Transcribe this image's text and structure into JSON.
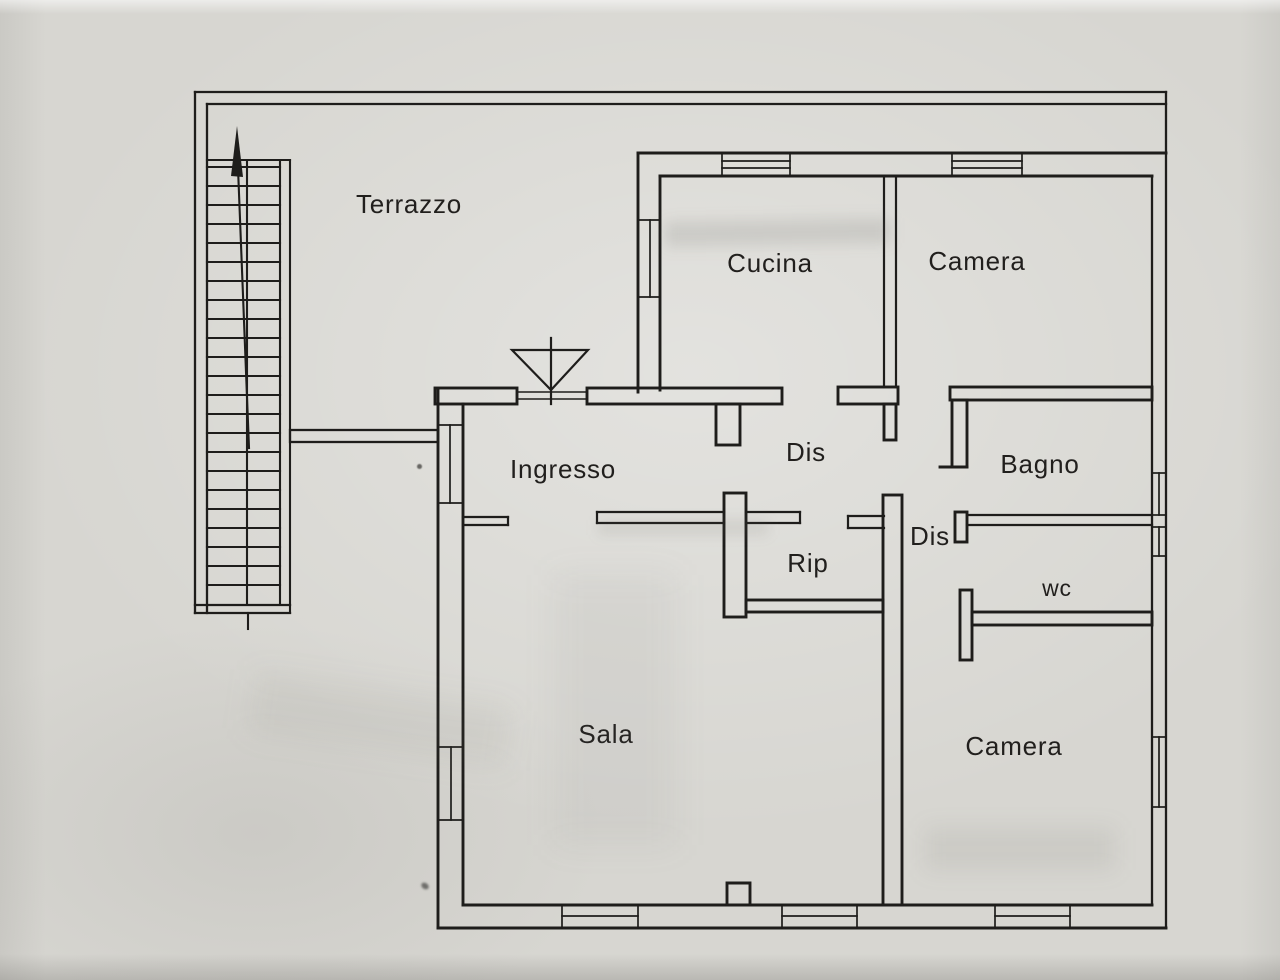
{
  "colors": {
    "paper": "#d7d6d1",
    "ink": "#1e1d1b"
  },
  "rooms": [
    {
      "id": "terrazzo",
      "label": "Terrazzo"
    },
    {
      "id": "cucina",
      "label": "Cucina"
    },
    {
      "id": "camera-nord",
      "label": "Camera"
    },
    {
      "id": "ingresso",
      "label": "Ingresso"
    },
    {
      "id": "disimpegno-1",
      "label": "Dis"
    },
    {
      "id": "bagno",
      "label": "Bagno"
    },
    {
      "id": "rip",
      "label": "Rip"
    },
    {
      "id": "disimpegno-2",
      "label": "Dis"
    },
    {
      "id": "wc",
      "label": "wc"
    },
    {
      "id": "sala",
      "label": "Sala"
    },
    {
      "id": "camera-sud",
      "label": "Camera"
    }
  ],
  "symbols": {
    "staircase": "external-switchback-stair",
    "staircase_arrow": "up-direction-arrow",
    "entrance_door": "door-swing-triangle",
    "window": "double-line-wall-opening"
  }
}
